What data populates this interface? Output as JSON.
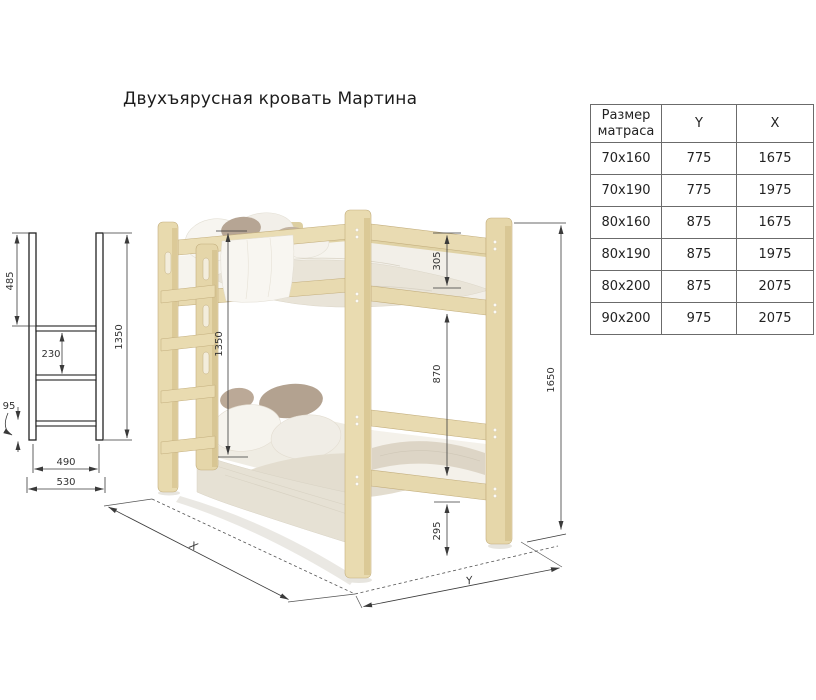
{
  "title": "Двухъярусная кровать Мартина",
  "table": {
    "headers": [
      "Размер матраса",
      "Y",
      "X"
    ],
    "rows": [
      [
        "70x160",
        "775",
        "1675"
      ],
      [
        "70x190",
        "775",
        "1975"
      ],
      [
        "80x160",
        "875",
        "1675"
      ],
      [
        "80x190",
        "875",
        "1975"
      ],
      [
        "80x200",
        "875",
        "2075"
      ],
      [
        "90x200",
        "975",
        "2075"
      ]
    ]
  },
  "drawing": {
    "ladder": {
      "total_height": "1350",
      "top_section": "485",
      "rung_spacing": "230",
      "bottom_offset": "95",
      "inner_width": "490",
      "outer_width": "530"
    },
    "bed": {
      "ladder_height": "1350",
      "top_rail_gap": "305",
      "bunk_clearance": "870",
      "under_bed_height": "295",
      "total_height": "1650",
      "length_label": "X",
      "width_label": "Y"
    }
  },
  "colors": {
    "wood": "#e8d9ad",
    "wood_shadow": "#d8c693",
    "bedding_white": "#f6f4ee",
    "accent_pillow": "#b3a290",
    "dimension_line": "#3a3a3a"
  }
}
